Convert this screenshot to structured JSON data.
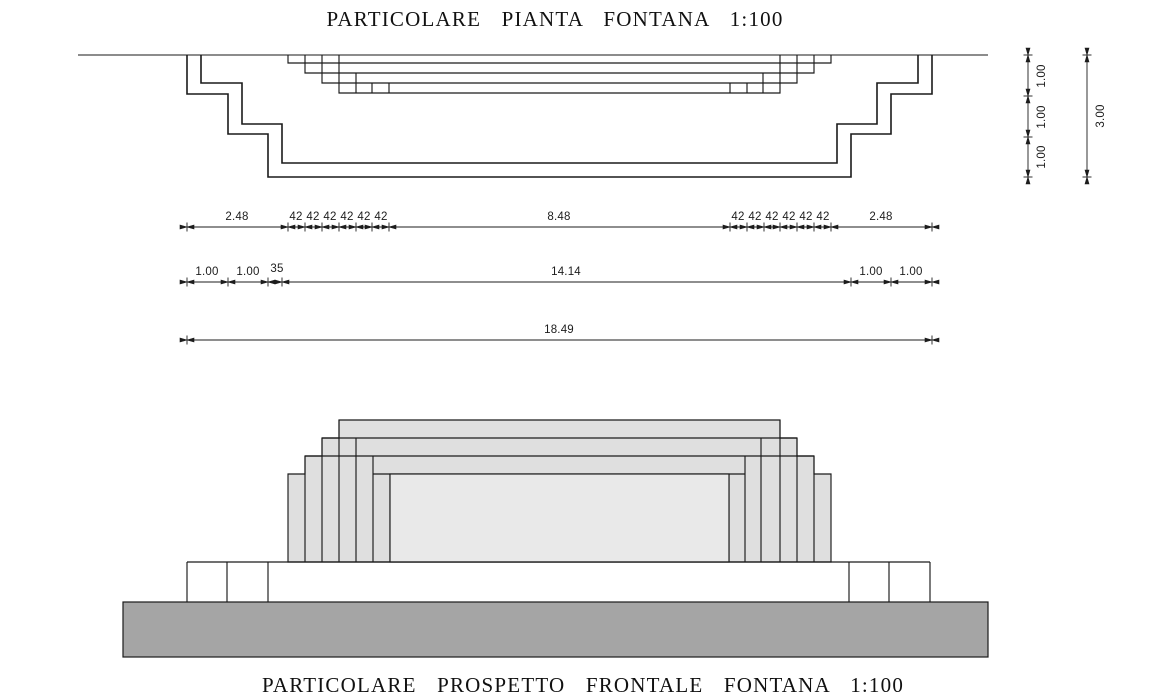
{
  "plan": {
    "title": "PARTICOLARE  PIANTA  FONTANA   1:100",
    "dims_row1": [
      "2.48",
      "42",
      "42",
      "42",
      "42",
      "42",
      "42",
      "8.48",
      "42",
      "42",
      "42",
      "42",
      "42",
      "42",
      "2.48"
    ],
    "dims_row2": [
      "1.00",
      "1.00",
      "35",
      "14.14",
      "1.00",
      "1.00"
    ],
    "dims_row3": [
      "18.49"
    ],
    "dims_vertical": [
      "1.00",
      "1.00",
      "1.00"
    ],
    "dims_vertical_total": "3.00"
  },
  "elevation": {
    "title": "PARTICOLARE  PROSPETTO  FRONTALE  FONTANA   1:100"
  },
  "colors": {
    "tier_fill": "#dfdfdf",
    "front_tier_fill": "#e9e9e9",
    "ground_fill": "#a5a5a5",
    "line": "#1a1a1a"
  }
}
